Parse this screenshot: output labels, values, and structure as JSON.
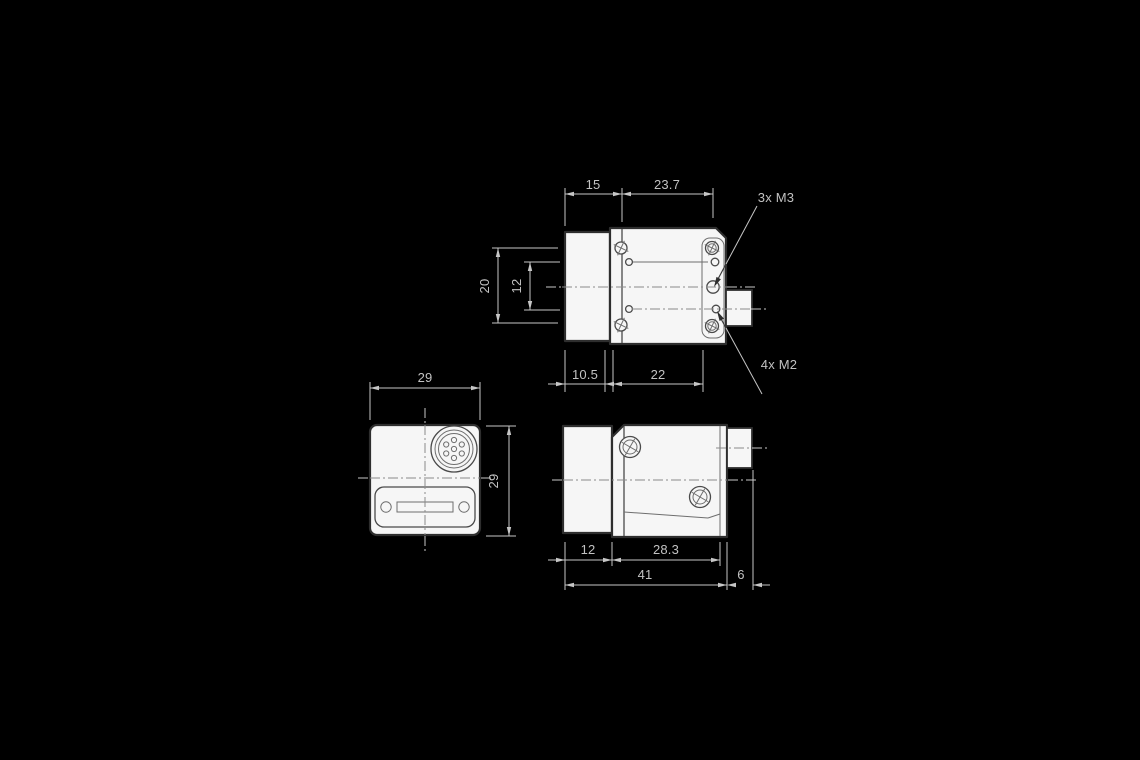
{
  "colors": {
    "background": "#000000",
    "paper": "#f6f6f6",
    "ink_dark": "#2e2e2e",
    "ink_light": "#c6c6c6"
  },
  "side_view": {
    "dims": {
      "lens_offset": "15",
      "body_top": "23.7",
      "lens_bottom": "10.5",
      "body_bottom": "22",
      "hole_span_outer": "20",
      "hole_span_inner": "12"
    },
    "labels": {
      "m3_thread": "3x M3",
      "m2_thread": "4x M2"
    }
  },
  "front_view": {
    "dims": {
      "width": "29",
      "height": "29"
    }
  },
  "rear_side_view": {
    "dims": {
      "front_section": "12",
      "rear_section": "28.3",
      "total_length": "41",
      "connector_depth": "6"
    }
  }
}
